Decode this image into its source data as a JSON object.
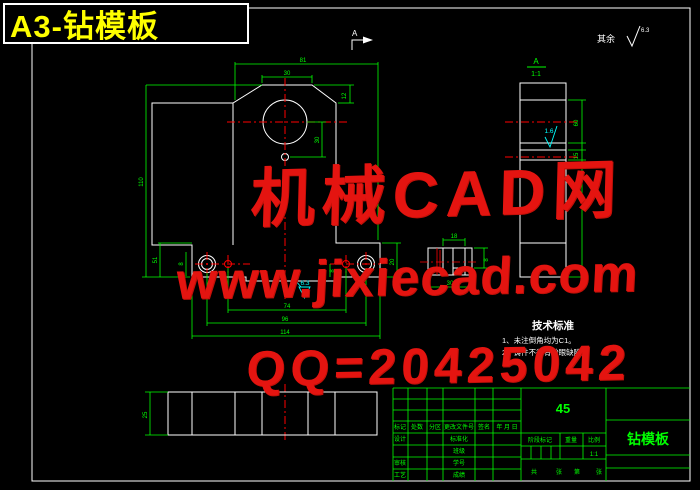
{
  "sheet": {
    "label": "A3-钻模板"
  },
  "corner_note": {
    "prefix": "其余",
    "roughness": "6.3"
  },
  "watermark": {
    "line1": "机械CAD网",
    "line2": "www.jixiecad.com",
    "line3": "QQ=20425042"
  },
  "front_view": {
    "section_arrow": "A",
    "dim_top_width": "81",
    "dim_plateau": "30",
    "dim_chamfer": "12",
    "dim_height": "110",
    "dim_flange": "51",
    "dim_flange_right": "20",
    "dim_center": "30",
    "dim_small_left": "8",
    "dim_small_right": "8",
    "dim_bottom_a": "74",
    "dim_bottom_b": "96",
    "dim_bottom_c": "114",
    "roughness_bottom": "6.3"
  },
  "side_view": {
    "view_label": "A",
    "view_scale": "1:1",
    "roughness": "1.6",
    "dim_a": "60",
    "dim_b": "15"
  },
  "detail_view": {
    "dim_top": "18",
    "dim_bottom": "30",
    "dim_side": "8"
  },
  "bottom_view": {
    "dim_width": "25"
  },
  "tech_notes": {
    "title": "技术标准",
    "items": [
      "1、未注倒角均为C1。",
      "2、铸件不得有砂眼缺陷。"
    ]
  },
  "title_block": {
    "material": "45",
    "part_name": "钻模板",
    "header": [
      "标记",
      "处数",
      "分区",
      "更改文件号",
      "签名",
      "年 月 日"
    ],
    "col1_rows": [
      "设计",
      "审核",
      "工艺"
    ],
    "col2_rows": [
      "标准化",
      "班级",
      "学号",
      "成绩"
    ],
    "stage": [
      "阶段标记",
      "重量",
      "比例"
    ],
    "scale": "1:1",
    "sheet_info": [
      "共",
      "张",
      "第",
      "张"
    ]
  }
}
